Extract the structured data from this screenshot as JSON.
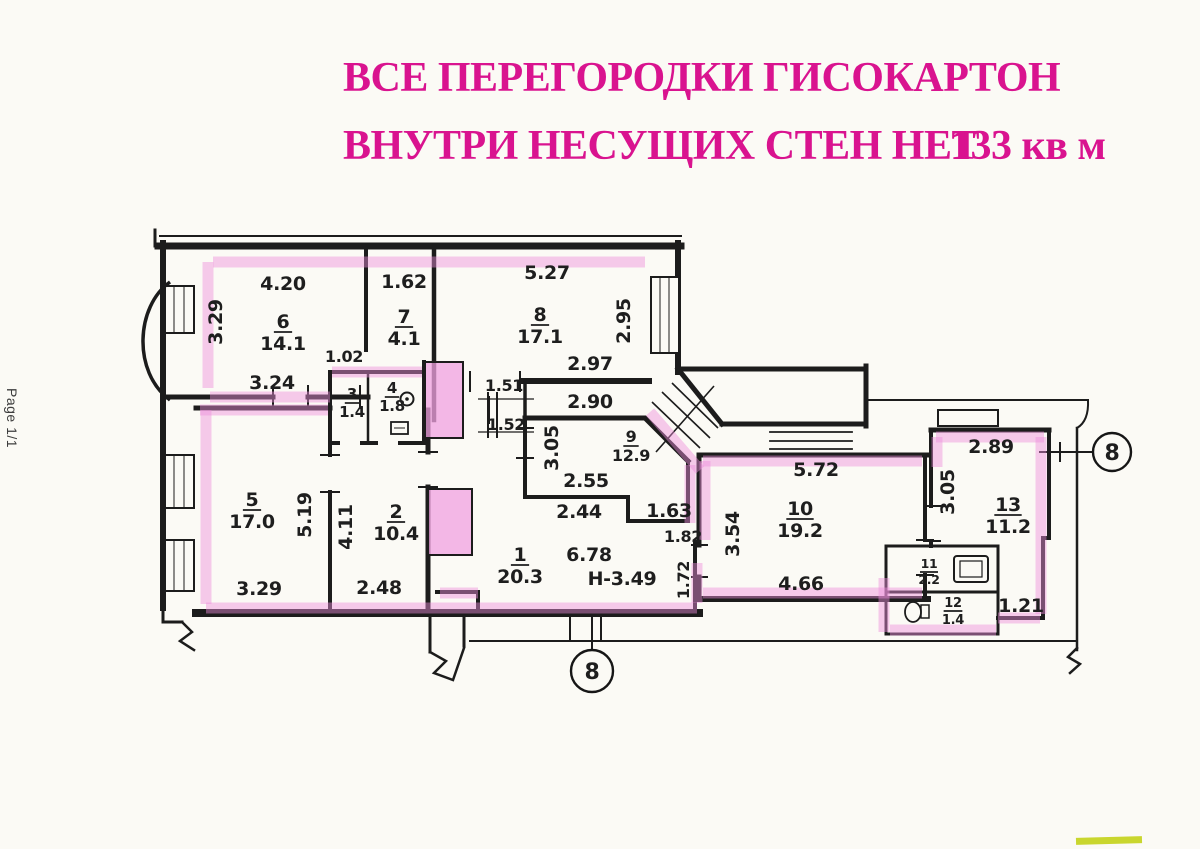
{
  "page": {
    "label": "Page 1/1"
  },
  "title": {
    "line1": "ВСЕ ПЕРЕГОРОДКИ ГИСОКАРТОН",
    "line2": "ВНУТРИ НЕСУЩИХ СТЕН НЕТ",
    "area_total": "133 кв м",
    "color": "#d9138f"
  },
  "plan": {
    "highlighter_color": "#ee8fdc",
    "wall_color": "#1c1c1c",
    "axis_markers": [
      {
        "label": "8",
        "x": 1112,
        "y": 452,
        "r": 19
      },
      {
        "label": "8",
        "x": 592,
        "y": 671,
        "r": 21
      }
    ],
    "rooms": [
      {
        "num": "6",
        "area": "14.1",
        "x": 283,
        "y": 328
      },
      {
        "num": "7",
        "area": "4.1",
        "x": 404,
        "y": 323
      },
      {
        "num": "8",
        "area": "17.1",
        "x": 540,
        "y": 321
      },
      {
        "num": "3",
        "area": "1.4",
        "x": 352,
        "y": 399,
        "s": 15,
        "o": 18
      },
      {
        "num": "4",
        "area": "1.8",
        "x": 392,
        "y": 393,
        "s": 15,
        "o": 18
      },
      {
        "num": "9",
        "area": "12.9",
        "x": 631,
        "y": 442,
        "s": 16,
        "o": 19
      },
      {
        "num": "5",
        "area": "17.0",
        "x": 252,
        "y": 506
      },
      {
        "num": "2",
        "area": "10.4",
        "x": 396,
        "y": 518
      },
      {
        "num": "1",
        "area": "20.3",
        "x": 520,
        "y": 561
      },
      {
        "num": "10",
        "area": "19.2",
        "x": 800,
        "y": 515
      },
      {
        "num": "13",
        "area": "11.2",
        "x": 1008,
        "y": 511
      },
      {
        "num": "11",
        "area": "2.2",
        "x": 929,
        "y": 568,
        "s": 12.5,
        "o": 16
      },
      {
        "num": "12",
        "area": "1.4",
        "x": 953,
        "y": 607,
        "s": 13,
        "o": 17
      }
    ],
    "dims": [
      {
        "t": "4.20",
        "x": 283,
        "y": 290
      },
      {
        "t": "1.62",
        "x": 404,
        "y": 288
      },
      {
        "t": "5.27",
        "x": 547,
        "y": 279
      },
      {
        "t": "1.02",
        "x": 344,
        "y": 362,
        "s": 16
      },
      {
        "t": "2.97",
        "x": 590,
        "y": 370
      },
      {
        "t": "3.24",
        "x": 272,
        "y": 389
      },
      {
        "t": "2.90",
        "x": 590,
        "y": 408
      },
      {
        "t": "1.51",
        "x": 504,
        "y": 391,
        "s": 16
      },
      {
        "t": "1.52",
        "x": 506,
        "y": 430,
        "s": 16
      },
      {
        "t": "2.55",
        "x": 586,
        "y": 487
      },
      {
        "t": "2.44",
        "x": 579,
        "y": 518
      },
      {
        "t": "1.63",
        "x": 669,
        "y": 517
      },
      {
        "t": "1.82",
        "x": 683,
        "y": 542,
        "s": 16
      },
      {
        "t": "6.78",
        "x": 589,
        "y": 561
      },
      {
        "t": "Н-3.49",
        "x": 622,
        "y": 585
      },
      {
        "t": "3.29",
        "x": 259,
        "y": 595
      },
      {
        "t": "2.48",
        "x": 379,
        "y": 594
      },
      {
        "t": "5.72",
        "x": 816,
        "y": 476
      },
      {
        "t": "4.66",
        "x": 801,
        "y": 590
      },
      {
        "t": "2.89",
        "x": 991,
        "y": 453
      },
      {
        "t": "1.21",
        "x": 1021,
        "y": 612
      },
      {
        "t": "3.29",
        "x": 222,
        "y": 322,
        "r": -90
      },
      {
        "t": "2.95",
        "x": 630,
        "y": 321,
        "r": -90
      },
      {
        "t": "3.05",
        "x": 558,
        "y": 448,
        "r": -90
      },
      {
        "t": "5.19",
        "x": 311,
        "y": 515,
        "r": -90
      },
      {
        "t": "4.11",
        "x": 352,
        "y": 527,
        "r": -90
      },
      {
        "t": "3.54",
        "x": 739,
        "y": 534,
        "r": -90
      },
      {
        "t": "1.72",
        "x": 689,
        "y": 580,
        "r": -90,
        "s": 16
      },
      {
        "t": "3.05",
        "x": 954,
        "y": 492,
        "r": -90
      }
    ]
  },
  "scan_artifacts": {
    "corner_mark_color": "#c3d118"
  }
}
